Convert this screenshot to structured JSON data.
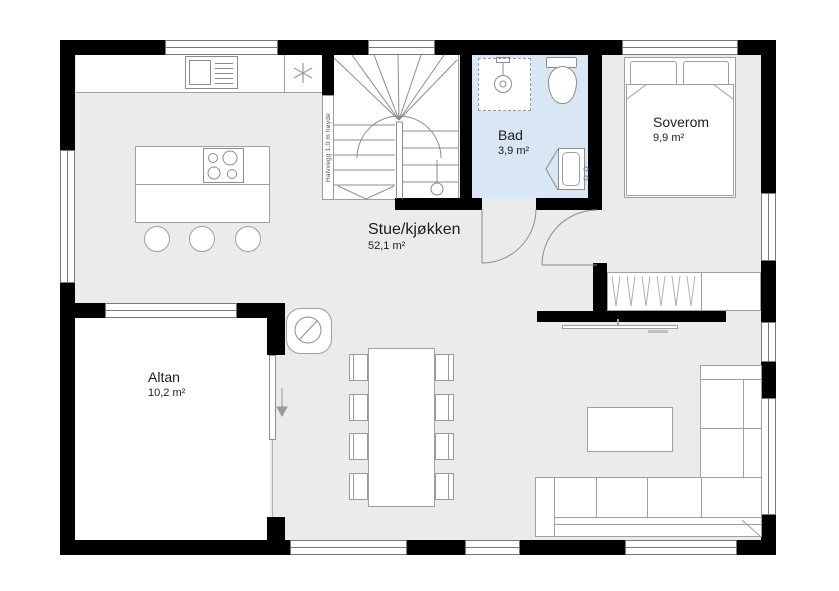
{
  "plan": {
    "rooms": [
      {
        "name": "Stue/kjøkken",
        "area": "52,1 m²"
      },
      {
        "name": "Bad",
        "area": "3,9 m²"
      },
      {
        "name": "Soverom",
        "area": "9,9 m²"
      },
      {
        "name": "Altan",
        "area": "10,2 m²"
      }
    ],
    "annotations": [
      {
        "text": "Halvvegg 1,0 m høyde"
      }
    ],
    "fixtures": [
      "staircase",
      "half-wall",
      "kitchen-counter",
      "kitchen-sink",
      "ceiling-light",
      "kitchen-island",
      "cooktop",
      "bar-stools",
      "dining-table",
      "dining-chairs",
      "wood-stove",
      "sliding-door",
      "slide-arrow",
      "shower",
      "toilet",
      "bathroom-vanity",
      "double-bed",
      "pillows",
      "duvet",
      "wardrobe",
      "tv",
      "coffee-table",
      "corner-sofa",
      "bathroom-door",
      "bedroom-door",
      "windows"
    ],
    "colors": {
      "wall": "#000000",
      "floor": "#ebebeb",
      "bathroom_floor": "#d9e6f3",
      "terrace_floor": "#ffffff",
      "outline": "#a0a0a0",
      "label_text": "#1c1c1c"
    }
  }
}
